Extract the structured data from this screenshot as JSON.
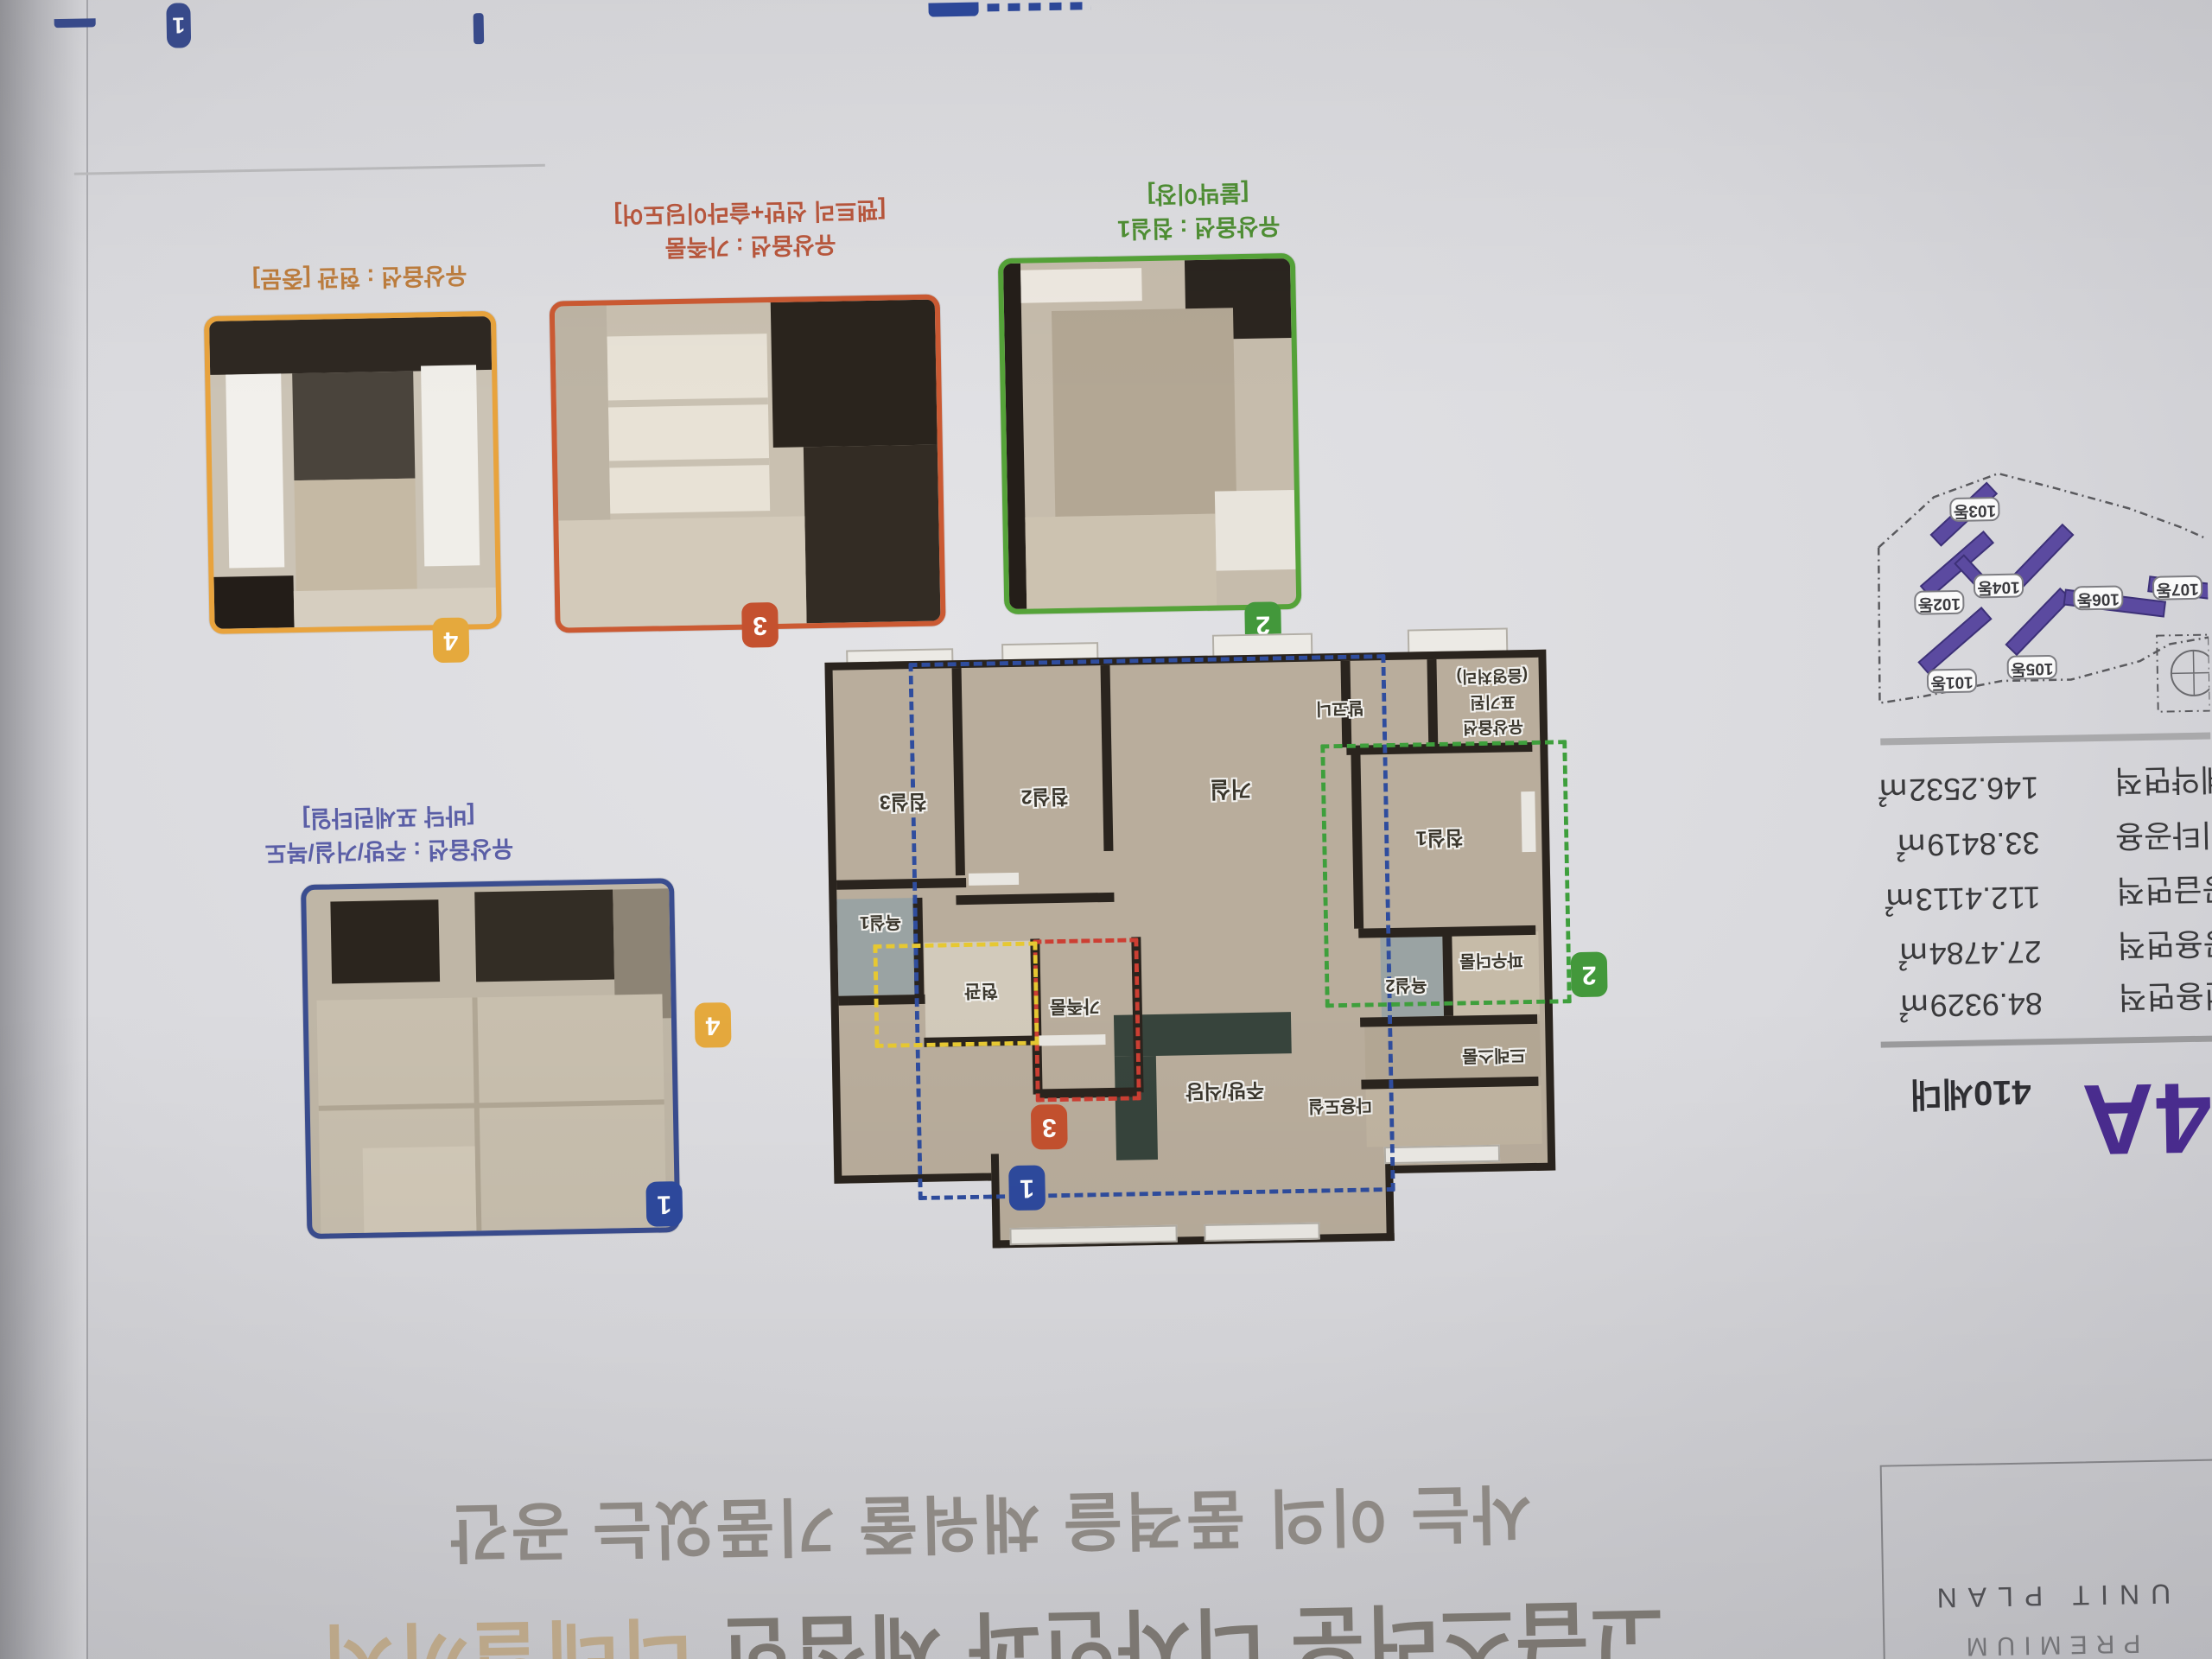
{
  "unit_summary": {
    "code": "84A",
    "households": "410세대"
  },
  "area_table": {
    "rows": [
      {
        "label": "계약면적",
        "value": "146.2532㎡"
      },
      {
        "label": "기타공용",
        "value": "33.8419㎡"
      },
      {
        "label": "공급면적",
        "value": "112.4113㎡"
      },
      {
        "label": "공용면적",
        "value": "27.4784㎡"
      },
      {
        "label": "전용면적",
        "value": "84.9329㎡"
      }
    ]
  },
  "site_map": {
    "buildings": [
      "101동",
      "102동",
      "103동",
      "104동",
      "105동",
      "106동",
      "107동"
    ]
  },
  "option_photos": [
    {
      "num": "4",
      "caption_line1": "유상옵션 : 현관 [중문]",
      "caption_line2": ""
    },
    {
      "num": "3",
      "caption_line1": "유상옵션 : 가족룸",
      "caption_line2": "[팬트리 선반+슬라이딩도어]"
    },
    {
      "num": "2",
      "caption_line1": "유상옵션 : 침실1",
      "caption_line2": "[붙박이장]"
    },
    {
      "num": "1",
      "caption_line1": "유상옵션 : 주방/거실/복도",
      "caption_line2": "[바닥 포세린타일]"
    }
  ],
  "floor_plan": {
    "rooms": {
      "living": "거실",
      "bed1": "침실1",
      "bed2": "침실2",
      "bed3": "침실3",
      "kitchen": "주방/식당",
      "entrance": "현관",
      "family": "가족룸",
      "bath1": "욕실1",
      "bath2": "욕실2",
      "powder": "파우더룸",
      "dress": "드레스룸",
      "utility": "다용도실",
      "balcony": "발코니"
    },
    "annotation": {
      "line1": "유상옵션",
      "line2": "표기된",
      "line3": "(음영처리)"
    },
    "region_badges": {
      "r1": "1",
      "r2": "2",
      "r3": "3",
      "r4": "4"
    }
  },
  "headline": {
    "line1": "사는 이의 품격을 채워줄 기품있는 공간",
    "line2_prefix": "고급스러운 디자인과 세심한 ",
    "line2_highlight": "디테일까지"
  },
  "footer_box": {
    "title": "UNIT PLAN",
    "subtitle": "PREMIUM"
  },
  "top_edge": {
    "badge": "1"
  },
  "colors": {
    "region1_blue": "#3a4d8f",
    "region2_green": "#55a339",
    "region3_orange": "#cb5a33",
    "region4_yellow": "#e8a33d",
    "brand_purple": "#4a2c8f"
  }
}
